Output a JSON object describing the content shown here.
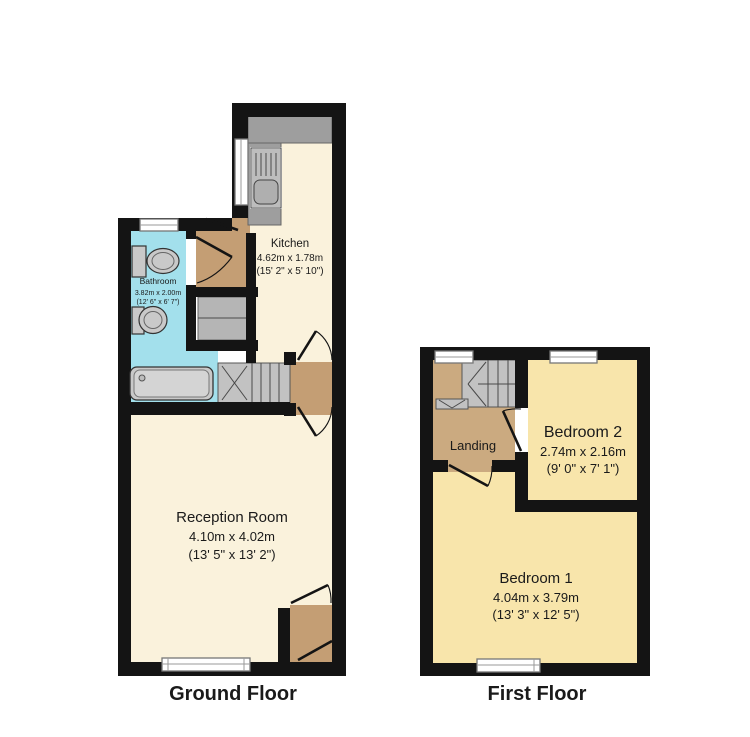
{
  "colors": {
    "wall": "#141414",
    "ground_room_fill": "#FAF2DC",
    "first_room_fill": "#F8E5AB",
    "bathroom_fill": "#A3E0EC",
    "hall_fill": "#C49E74",
    "landing_fill": "#CBAA80",
    "stairs_fill": "#C2C2C2",
    "counter_fill": "#9E9E9E",
    "cupboard_fill": "#B5B5B5",
    "fixture_fill": "#C9C9C9",
    "window_fill": "#FFFFFF"
  },
  "ground_floor": {
    "label": "Ground Floor",
    "rooms": {
      "kitchen": {
        "name": "Kitchen",
        "metric": "4.62m x 1.78m",
        "imperial": "(15' 2\" x 5' 10\")"
      },
      "bathroom": {
        "name": "Bathroom",
        "metric": "3.82m x 2.00m",
        "imperial": "(12' 6\" x 6' 7\")"
      },
      "reception": {
        "name": "Reception Room",
        "metric": "4.10m x 4.02m",
        "imperial": "(13' 5\" x 13' 2\")"
      }
    }
  },
  "first_floor": {
    "label": "First Floor",
    "rooms": {
      "landing": {
        "name": "Landing"
      },
      "bedroom2": {
        "name": "Bedroom 2",
        "metric": "2.74m x 2.16m",
        "imperial": "(9' 0\" x 7' 1\")"
      },
      "bedroom1": {
        "name": "Bedroom 1",
        "metric": "4.04m x 3.79m",
        "imperial": "(13' 3\" x 12' 5\")"
      }
    }
  }
}
